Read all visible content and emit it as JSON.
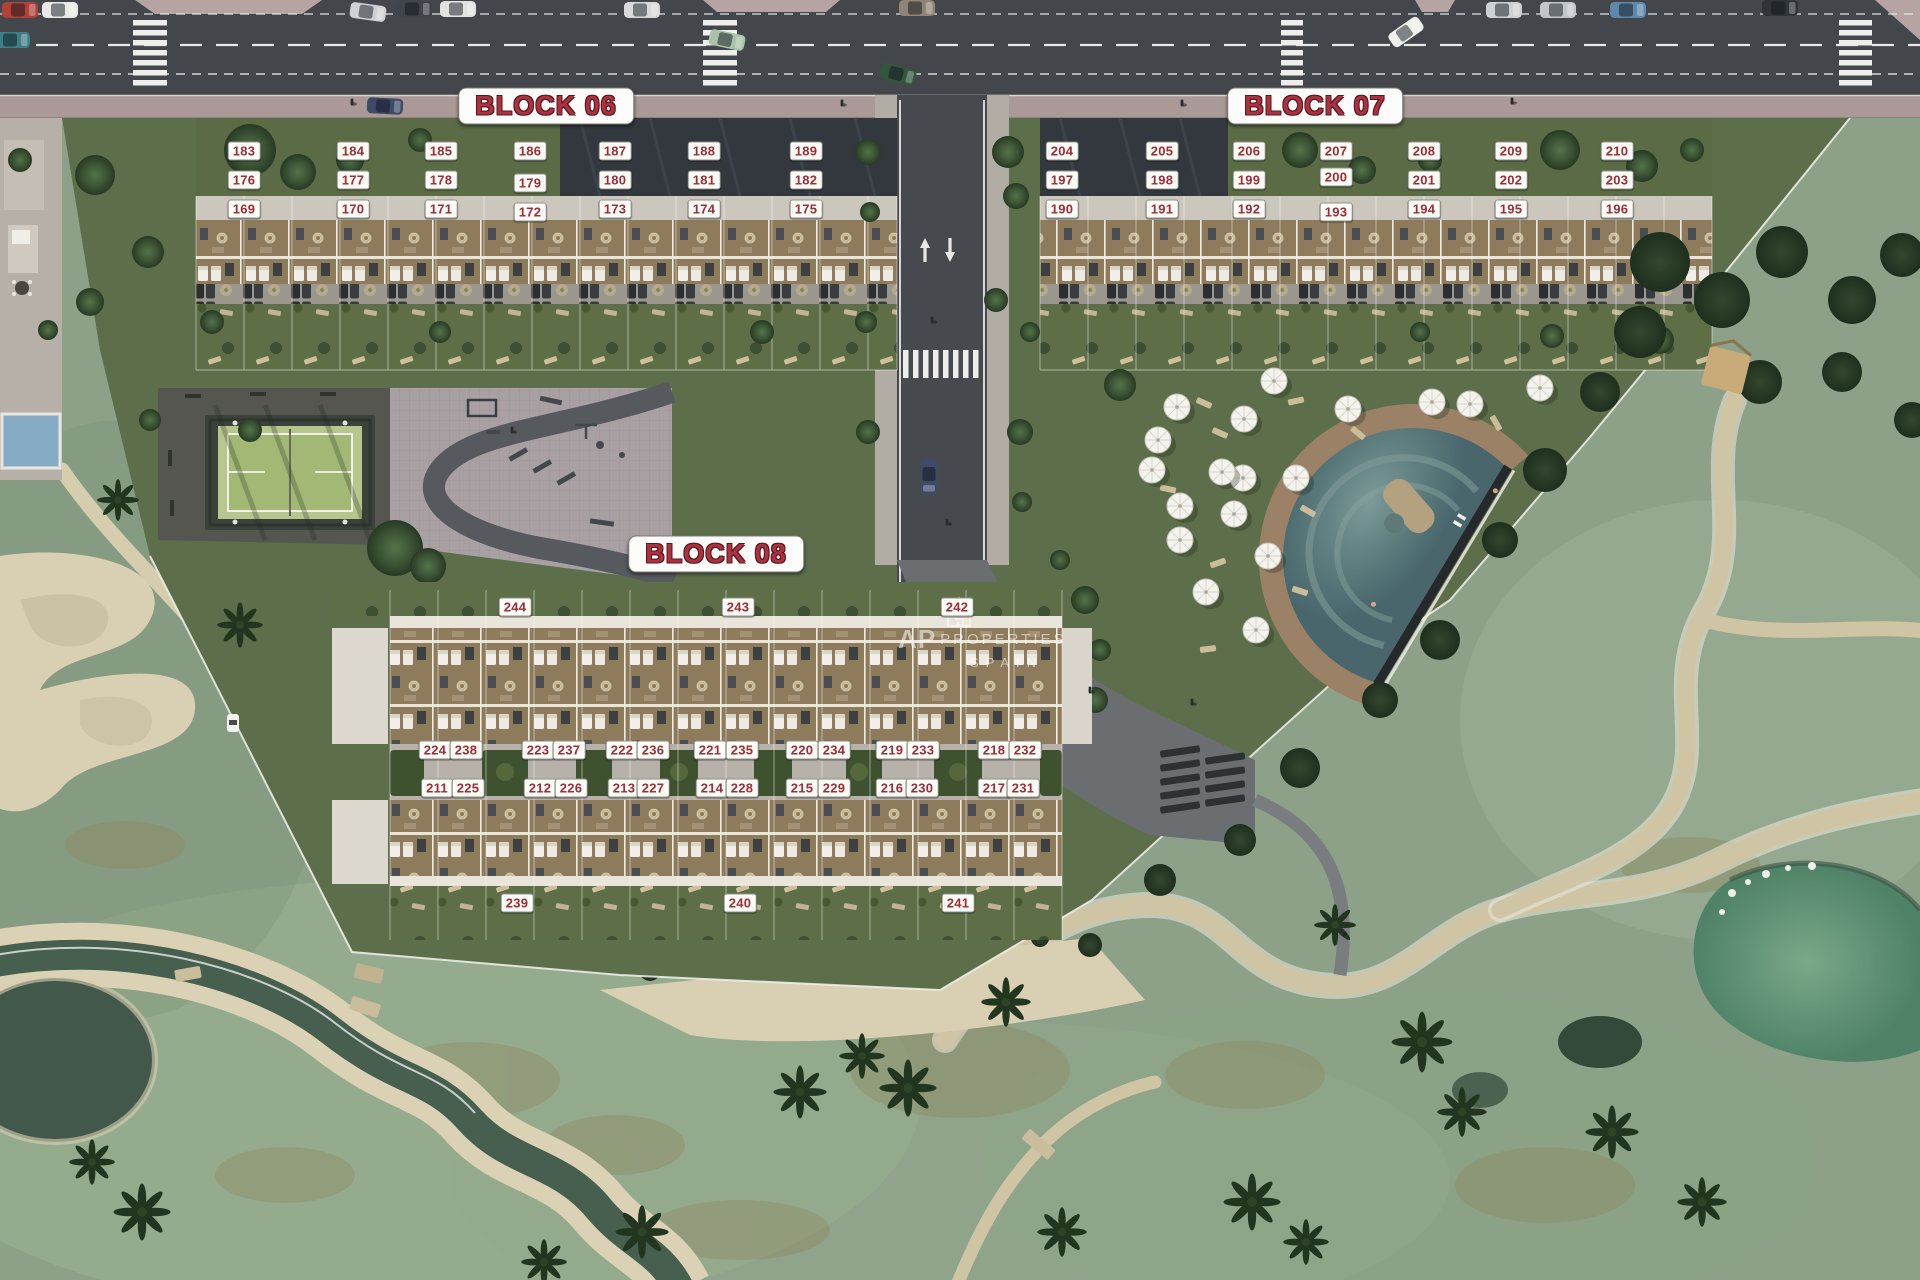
{
  "accent": {
    "label_red": "#9e2b38",
    "badge_bg": "#fdfdf8",
    "title_red": "#a93340"
  },
  "watermark": {
    "ap": "AP",
    "properties": "PROPERTIES",
    "spain": "SPAIN"
  },
  "block_titles": [
    {
      "id": "block-06",
      "label": "BLOCK 06",
      "x": 546,
      "y": 106
    },
    {
      "id": "block-07",
      "label": "BLOCK 07",
      "x": 1315,
      "y": 106
    },
    {
      "id": "block-08",
      "label": "BLOCK 08",
      "x": 716,
      "y": 554
    }
  ],
  "unit_badges": [
    {
      "label": "183",
      "x": 244,
      "y": 151
    },
    {
      "label": "184",
      "x": 353,
      "y": 151
    },
    {
      "label": "185",
      "x": 441,
      "y": 151
    },
    {
      "label": "186",
      "x": 530,
      "y": 151
    },
    {
      "label": "187",
      "x": 615,
      "y": 151
    },
    {
      "label": "188",
      "x": 704,
      "y": 151
    },
    {
      "label": "189",
      "x": 806,
      "y": 151
    },
    {
      "label": "176",
      "x": 244,
      "y": 180
    },
    {
      "label": "177",
      "x": 353,
      "y": 180
    },
    {
      "label": "178",
      "x": 441,
      "y": 180
    },
    {
      "label": "179",
      "x": 530,
      "y": 183
    },
    {
      "label": "180",
      "x": 615,
      "y": 180
    },
    {
      "label": "181",
      "x": 704,
      "y": 180
    },
    {
      "label": "182",
      "x": 806,
      "y": 180
    },
    {
      "label": "169",
      "x": 244,
      "y": 209
    },
    {
      "label": "170",
      "x": 353,
      "y": 209
    },
    {
      "label": "171",
      "x": 441,
      "y": 209
    },
    {
      "label": "172",
      "x": 530,
      "y": 212
    },
    {
      "label": "173",
      "x": 615,
      "y": 209
    },
    {
      "label": "174",
      "x": 704,
      "y": 209
    },
    {
      "label": "175",
      "x": 806,
      "y": 209
    },
    {
      "label": "204",
      "x": 1062,
      "y": 151
    },
    {
      "label": "205",
      "x": 1162,
      "y": 151
    },
    {
      "label": "206",
      "x": 1249,
      "y": 151
    },
    {
      "label": "207",
      "x": 1336,
      "y": 151
    },
    {
      "label": "208",
      "x": 1424,
      "y": 151
    },
    {
      "label": "209",
      "x": 1511,
      "y": 151
    },
    {
      "label": "210",
      "x": 1617,
      "y": 151
    },
    {
      "label": "197",
      "x": 1062,
      "y": 180
    },
    {
      "label": "198",
      "x": 1162,
      "y": 180
    },
    {
      "label": "199",
      "x": 1249,
      "y": 180
    },
    {
      "label": "200",
      "x": 1336,
      "y": 177
    },
    {
      "label": "201",
      "x": 1424,
      "y": 180
    },
    {
      "label": "202",
      "x": 1511,
      "y": 180
    },
    {
      "label": "203",
      "x": 1617,
      "y": 180
    },
    {
      "label": "190",
      "x": 1062,
      "y": 209
    },
    {
      "label": "191",
      "x": 1162,
      "y": 209
    },
    {
      "label": "192",
      "x": 1249,
      "y": 209
    },
    {
      "label": "193",
      "x": 1336,
      "y": 212
    },
    {
      "label": "194",
      "x": 1424,
      "y": 209
    },
    {
      "label": "195",
      "x": 1511,
      "y": 209
    },
    {
      "label": "196",
      "x": 1617,
      "y": 209
    },
    {
      "label": "244",
      "x": 515,
      "y": 607
    },
    {
      "label": "243",
      "x": 738,
      "y": 607
    },
    {
      "label": "242",
      "x": 957,
      "y": 607
    },
    {
      "label": "224",
      "x": 435,
      "y": 750
    },
    {
      "label": "238",
      "x": 466,
      "y": 750
    },
    {
      "label": "223",
      "x": 538,
      "y": 750
    },
    {
      "label": "237",
      "x": 569,
      "y": 750
    },
    {
      "label": "222",
      "x": 622,
      "y": 750
    },
    {
      "label": "236",
      "x": 653,
      "y": 750
    },
    {
      "label": "221",
      "x": 710,
      "y": 750
    },
    {
      "label": "235",
      "x": 742,
      "y": 750
    },
    {
      "label": "220",
      "x": 802,
      "y": 750
    },
    {
      "label": "234",
      "x": 834,
      "y": 750
    },
    {
      "label": "219",
      "x": 892,
      "y": 750
    },
    {
      "label": "233",
      "x": 923,
      "y": 750
    },
    {
      "label": "218",
      "x": 994,
      "y": 750
    },
    {
      "label": "232",
      "x": 1025,
      "y": 750
    },
    {
      "label": "211",
      "x": 437,
      "y": 788
    },
    {
      "label": "225",
      "x": 468,
      "y": 788
    },
    {
      "label": "212",
      "x": 540,
      "y": 788
    },
    {
      "label": "226",
      "x": 571,
      "y": 788
    },
    {
      "label": "213",
      "x": 624,
      "y": 788
    },
    {
      "label": "227",
      "x": 653,
      "y": 788
    },
    {
      "label": "214",
      "x": 712,
      "y": 788
    },
    {
      "label": "228",
      "x": 742,
      "y": 788
    },
    {
      "label": "215",
      "x": 802,
      "y": 788
    },
    {
      "label": "229",
      "x": 834,
      "y": 788
    },
    {
      "label": "216",
      "x": 892,
      "y": 788
    },
    {
      "label": "230",
      "x": 922,
      "y": 788
    },
    {
      "label": "217",
      "x": 994,
      "y": 788
    },
    {
      "label": "231",
      "x": 1023,
      "y": 788
    },
    {
      "label": "239",
      "x": 517,
      "y": 903
    },
    {
      "label": "240",
      "x": 740,
      "y": 903
    },
    {
      "label": "241",
      "x": 958,
      "y": 903
    }
  ]
}
